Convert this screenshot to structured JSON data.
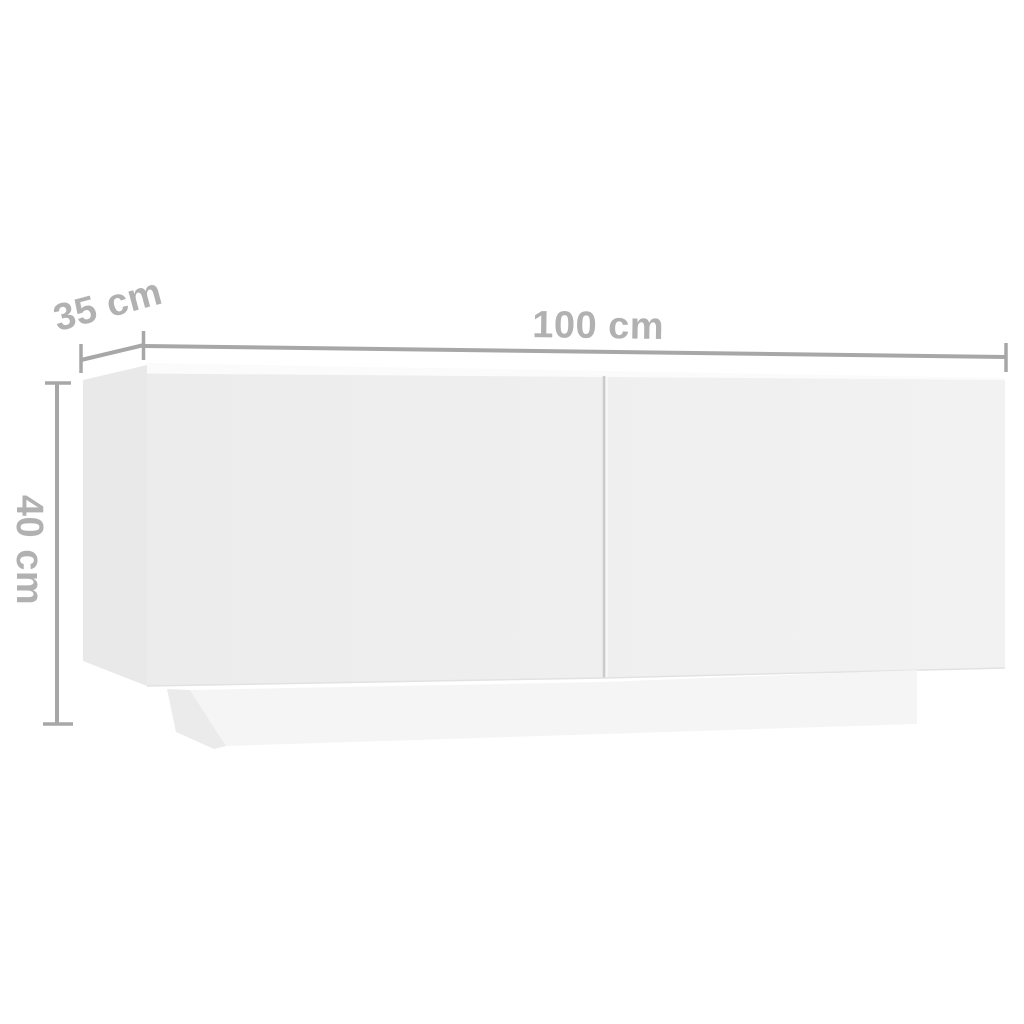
{
  "diagram": {
    "subject": "white TV cabinet with two doors on a recessed plinth, shown in light perspective",
    "type": "product-dimension-diagram",
    "background": "#ffffff"
  },
  "dimensions": {
    "width": {
      "label": "100 cm",
      "value": 100,
      "unit": "cm"
    },
    "depth": {
      "label": "35 cm",
      "value": 35,
      "unit": "cm"
    },
    "height": {
      "label": "40 cm",
      "value": 40,
      "unit": "cm"
    }
  },
  "colors": {
    "background": "#ffffff",
    "dimension_line": "#a7a7a7",
    "dimension_label": "#b1b1b1",
    "cabinet_side_face": "#e9e9e9",
    "cabinet_top_face": "#fbfbfb",
    "cabinet_front_face_left": "#ececec",
    "cabinet_front_face_right": "#f2f2f2",
    "door_divider": "#cbcbcb",
    "door_divider_highlight": "#f8f8f8",
    "bottom_edge": "#e2e2e2",
    "plinth_side_face": "#ebebeb",
    "plinth_front_face": "#f5f5f5"
  }
}
